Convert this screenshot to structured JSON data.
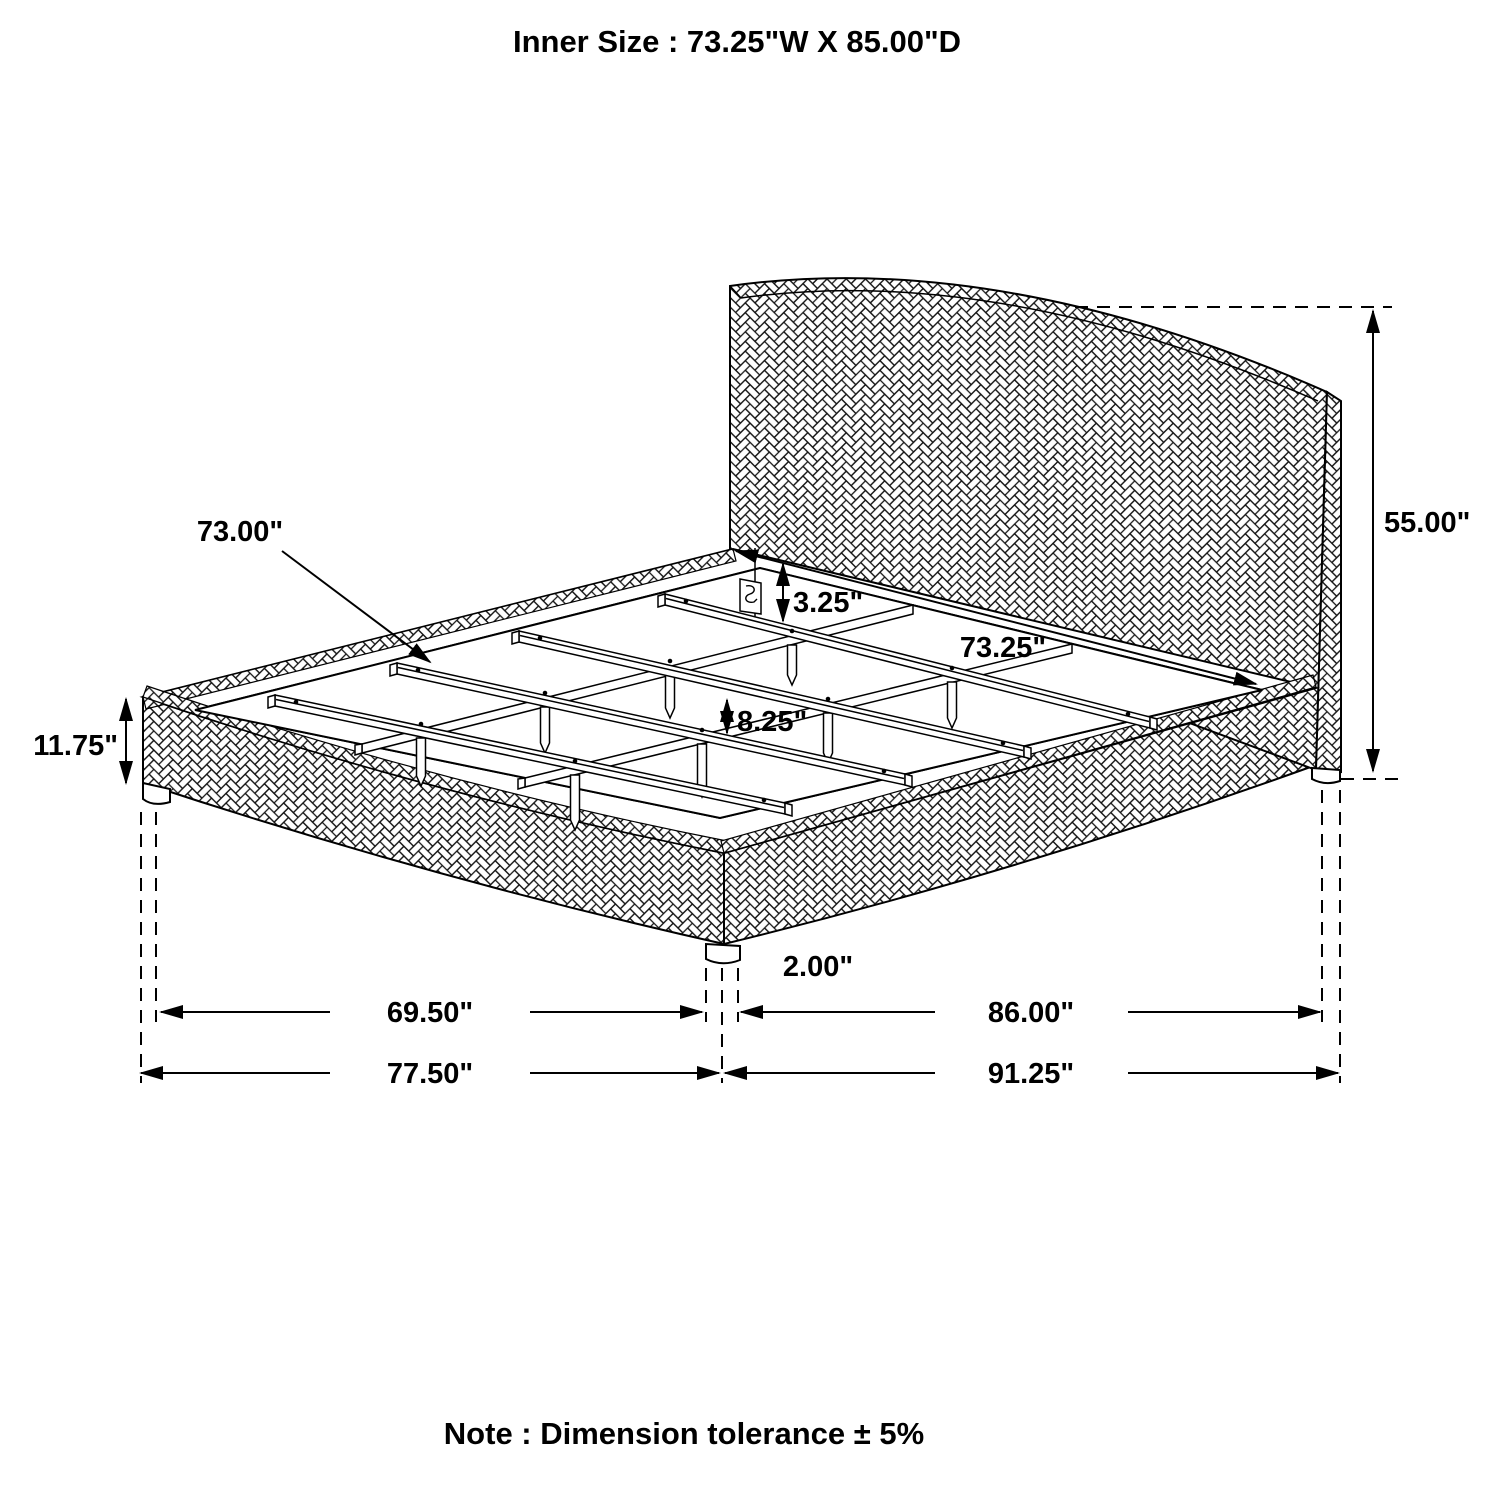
{
  "title": "Inner Size : 73.25\"W X 85.00\"D",
  "note": "Note : Dimension tolerance ± 5%",
  "diagram": {
    "subject": "Upholstered platform bed with arched woven headboard, slat and center-rail support system, isometric dimension drawing",
    "line_color": "#000000",
    "background_color": "#ffffff",
    "texture": "herringbone-weave upholstery hatch",
    "dimensions": {
      "slat_length": "73.00\"",
      "headboard_height": "55.00\"",
      "headboard_ledge_recess": "3.25\"",
      "inner_width": "73.25\"",
      "slat_spacing": "8.25\"",
      "base_rail_height": "11.75\"",
      "foot_leg_height": "2.00\"",
      "width_between_legs": "69.50\"",
      "overall_width": "77.50\"",
      "depth_between_legs": "86.00\"",
      "overall_depth": "91.25\""
    }
  }
}
